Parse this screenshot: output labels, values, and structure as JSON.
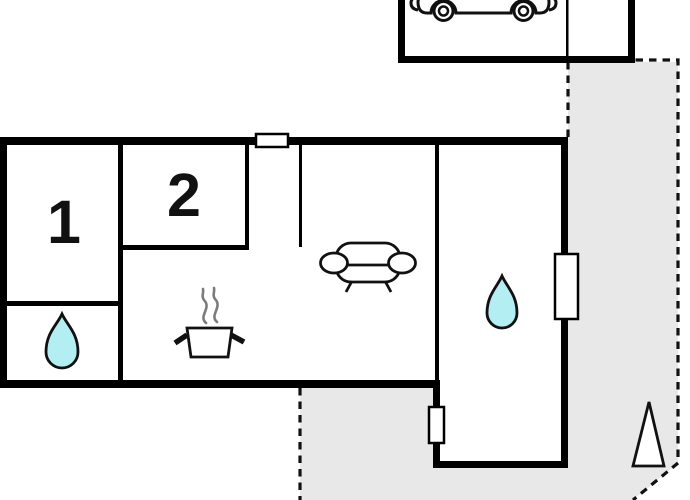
{
  "floorplan": {
    "room_labels": [
      {
        "id": "room-1",
        "label": "1"
      },
      {
        "id": "room-2",
        "label": "2"
      }
    ],
    "colors": {
      "wall": "#000000",
      "outline": "#111111",
      "terrace": "#e8e8e8",
      "water": "#b2eef2",
      "steam": "#7c7c7c",
      "background": "#ffffff"
    },
    "icons": {
      "car": "car-icon",
      "sofa": "sofa-icon",
      "pot": "cooking-pot-icon",
      "steam": "steam-icon",
      "water_drop": "water-drop-icon",
      "north_arrow": "north-arrow-icon",
      "window": "window-marker"
    }
  }
}
